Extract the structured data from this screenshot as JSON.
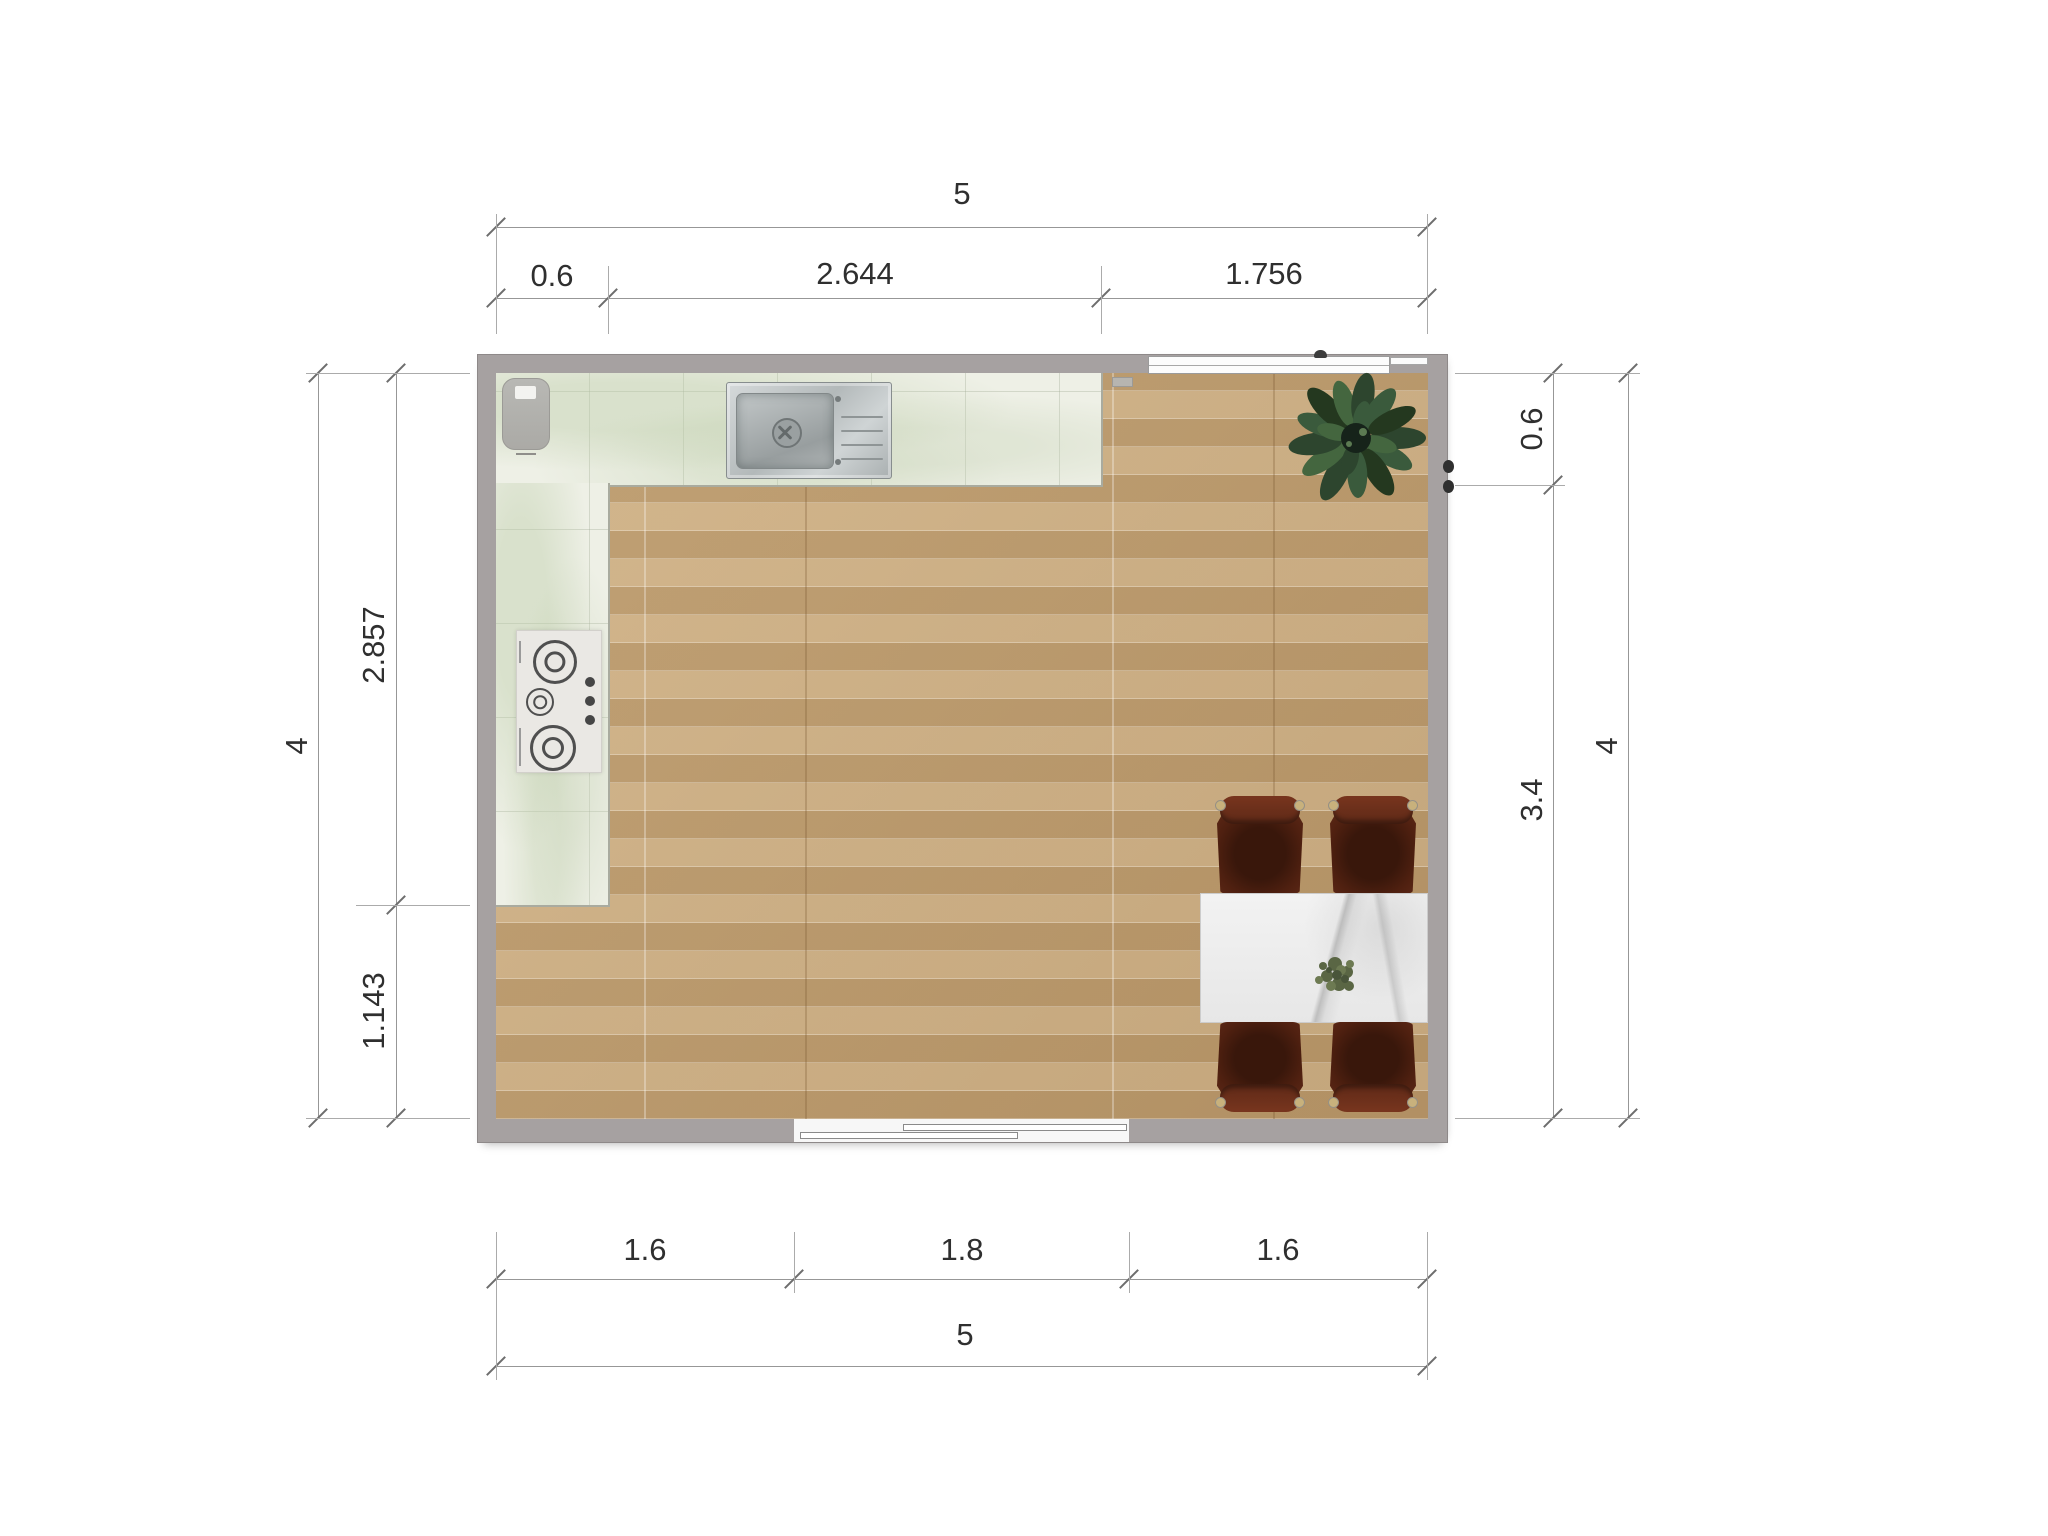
{
  "drawing": {
    "type": "floor-plan",
    "room": "kitchen-dining",
    "units_shown": false
  },
  "dimensions": {
    "top": {
      "total": "5",
      "segments": [
        "0.6",
        "2.644",
        "1.756"
      ]
    },
    "bottom": {
      "total": "5",
      "segments": [
        "1.6",
        "1.8",
        "1.6"
      ]
    },
    "left": {
      "total": "4",
      "segments": [
        "2.857",
        "1.143"
      ]
    },
    "right": {
      "total": "4",
      "segments": [
        "0.6",
        "3.4"
      ]
    }
  },
  "fixtures": {
    "sink": "kitchen-sink-with-drainboard",
    "cooktop": "three-burner-gas-cooktop",
    "corner_appliance": "countertop-appliance",
    "window": "window",
    "door": "sliding-door",
    "table": "marble-dining-table",
    "chairs": "upholstered-dining-chair",
    "chair_count": 4,
    "plant_large": "potted-plant",
    "plant_small": "table-centerpiece-plant"
  },
  "colors": {
    "wall": "#a6a1a1",
    "floor_wood": "#c3a274",
    "counter_marble": "#eef0e6",
    "table_marble": "#ebebeb",
    "chair": "#5d2817",
    "plant": "#3a5a3c",
    "steel": "#c2c7c8",
    "dimension_line": "#979797",
    "dimension_text": "#2f2f2f"
  }
}
